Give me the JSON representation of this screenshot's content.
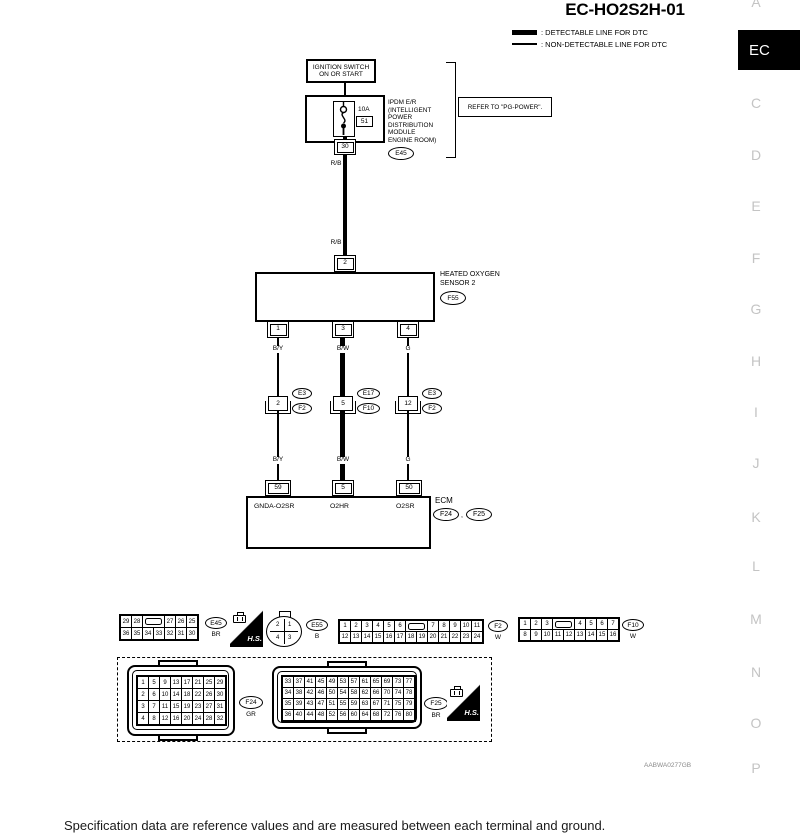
{
  "page": {
    "title": "EC-HO2S2H-01",
    "legend": [
      {
        "label": ": DETECTABLE LINE FOR DTC"
      },
      {
        "label": ": NON-DETECTABLE LINE FOR DTC"
      }
    ],
    "figure_code": "AABWA0277GB",
    "footer_note": "Specification data are reference values and are measured between each terminal and ground."
  },
  "sidebar": {
    "active": "EC",
    "items": [
      "A",
      "EC",
      "C",
      "D",
      "E",
      "F",
      "G",
      "H",
      "I",
      "J",
      "K",
      "L",
      "M",
      "N",
      "O",
      "P"
    ]
  },
  "diagram": {
    "ignition_switch": {
      "line1": "IGNITION SWITCH",
      "line2": "ON OR START"
    },
    "fuse": {
      "rating": "10A",
      "number": "51"
    },
    "ipdm": {
      "name_lines": [
        "IPDM E/R",
        "(INTELLIGENT",
        "POWER",
        "DISTRIBUTION",
        "MODULE",
        "ENGINE ROOM)"
      ],
      "connector": "E45",
      "terminal": "30"
    },
    "refer_note": "REFER TO \"PG-POWER\".",
    "wires": {
      "battery_upper": "R/B",
      "battery_lower": "R/B",
      "upper": [
        "B/Y",
        "B/W",
        "G"
      ],
      "lower": [
        "B/Y",
        "B/W",
        "G"
      ]
    },
    "sensor": {
      "name_line1": "HEATED OXYGEN",
      "name_line2": "SENSOR 2",
      "connector": "F55",
      "terminal_top": "2",
      "terminals_bottom": [
        "1",
        "3",
        "4"
      ]
    },
    "joints": [
      {
        "terminal": "2",
        "upper": "E3",
        "lower": "F2"
      },
      {
        "terminal": "5",
        "upper": "E17",
        "lower": "F10"
      },
      {
        "terminal": "12",
        "upper": "E3",
        "lower": "F2"
      }
    ],
    "ecm": {
      "name": "ECM",
      "terminals": [
        "59",
        "5",
        "50"
      ],
      "signals": [
        "GNDA-O2SR",
        "O2HR",
        "O2SR"
      ],
      "connectors": [
        "F24",
        "F25"
      ],
      "separator": ","
    }
  },
  "connector_views": {
    "hs_label": "H.S.",
    "e45": {
      "id": "E45",
      "color": "BR",
      "rows": [
        [
          "29",
          "28",
          "",
          "27",
          "26",
          "25"
        ],
        [
          "36",
          "35",
          "34",
          "33",
          "32",
          "31",
          "30"
        ]
      ]
    },
    "e55": {
      "id": "E55",
      "color": "B",
      "quadrants": [
        "2",
        "1",
        "4",
        "3"
      ]
    },
    "f2": {
      "id": "F2",
      "color": "W",
      "rows": [
        [
          "1",
          "2",
          "3",
          "4",
          "5",
          "6",
          "",
          "7",
          "8",
          "9",
          "10",
          "11"
        ],
        [
          "12",
          "13",
          "14",
          "15",
          "16",
          "17",
          "18",
          "19",
          "20",
          "21",
          "22",
          "23",
          "24"
        ]
      ]
    },
    "f10": {
      "id": "F10",
      "color": "W",
      "rows": [
        [
          "1",
          "2",
          "3",
          "",
          "4",
          "5",
          "6",
          "7"
        ],
        [
          "8",
          "9",
          "10",
          "11",
          "12",
          "13",
          "14",
          "15",
          "16"
        ]
      ]
    },
    "f24": {
      "id": "F24",
      "color": "GR",
      "rows": [
        [
          "1",
          "5",
          "9",
          "13",
          "17",
          "21",
          "25",
          "29"
        ],
        [
          "2",
          "6",
          "10",
          "14",
          "18",
          "22",
          "26",
          "30"
        ],
        [
          "3",
          "7",
          "11",
          "15",
          "19",
          "23",
          "27",
          "31"
        ],
        [
          "4",
          "8",
          "12",
          "16",
          "20",
          "24",
          "28",
          "32"
        ]
      ]
    },
    "f25": {
      "id": "F25",
      "color": "BR",
      "rows": [
        [
          "33",
          "37",
          "41",
          "45",
          "49",
          "53",
          "57",
          "61",
          "65",
          "69",
          "73",
          "77"
        ],
        [
          "34",
          "38",
          "42",
          "46",
          "50",
          "54",
          "58",
          "62",
          "66",
          "70",
          "74",
          "78"
        ],
        [
          "35",
          "39",
          "43",
          "47",
          "51",
          "55",
          "59",
          "63",
          "67",
          "71",
          "75",
          "79"
        ],
        [
          "36",
          "40",
          "44",
          "48",
          "52",
          "56",
          "60",
          "64",
          "68",
          "72",
          "76",
          "80"
        ]
      ]
    }
  }
}
